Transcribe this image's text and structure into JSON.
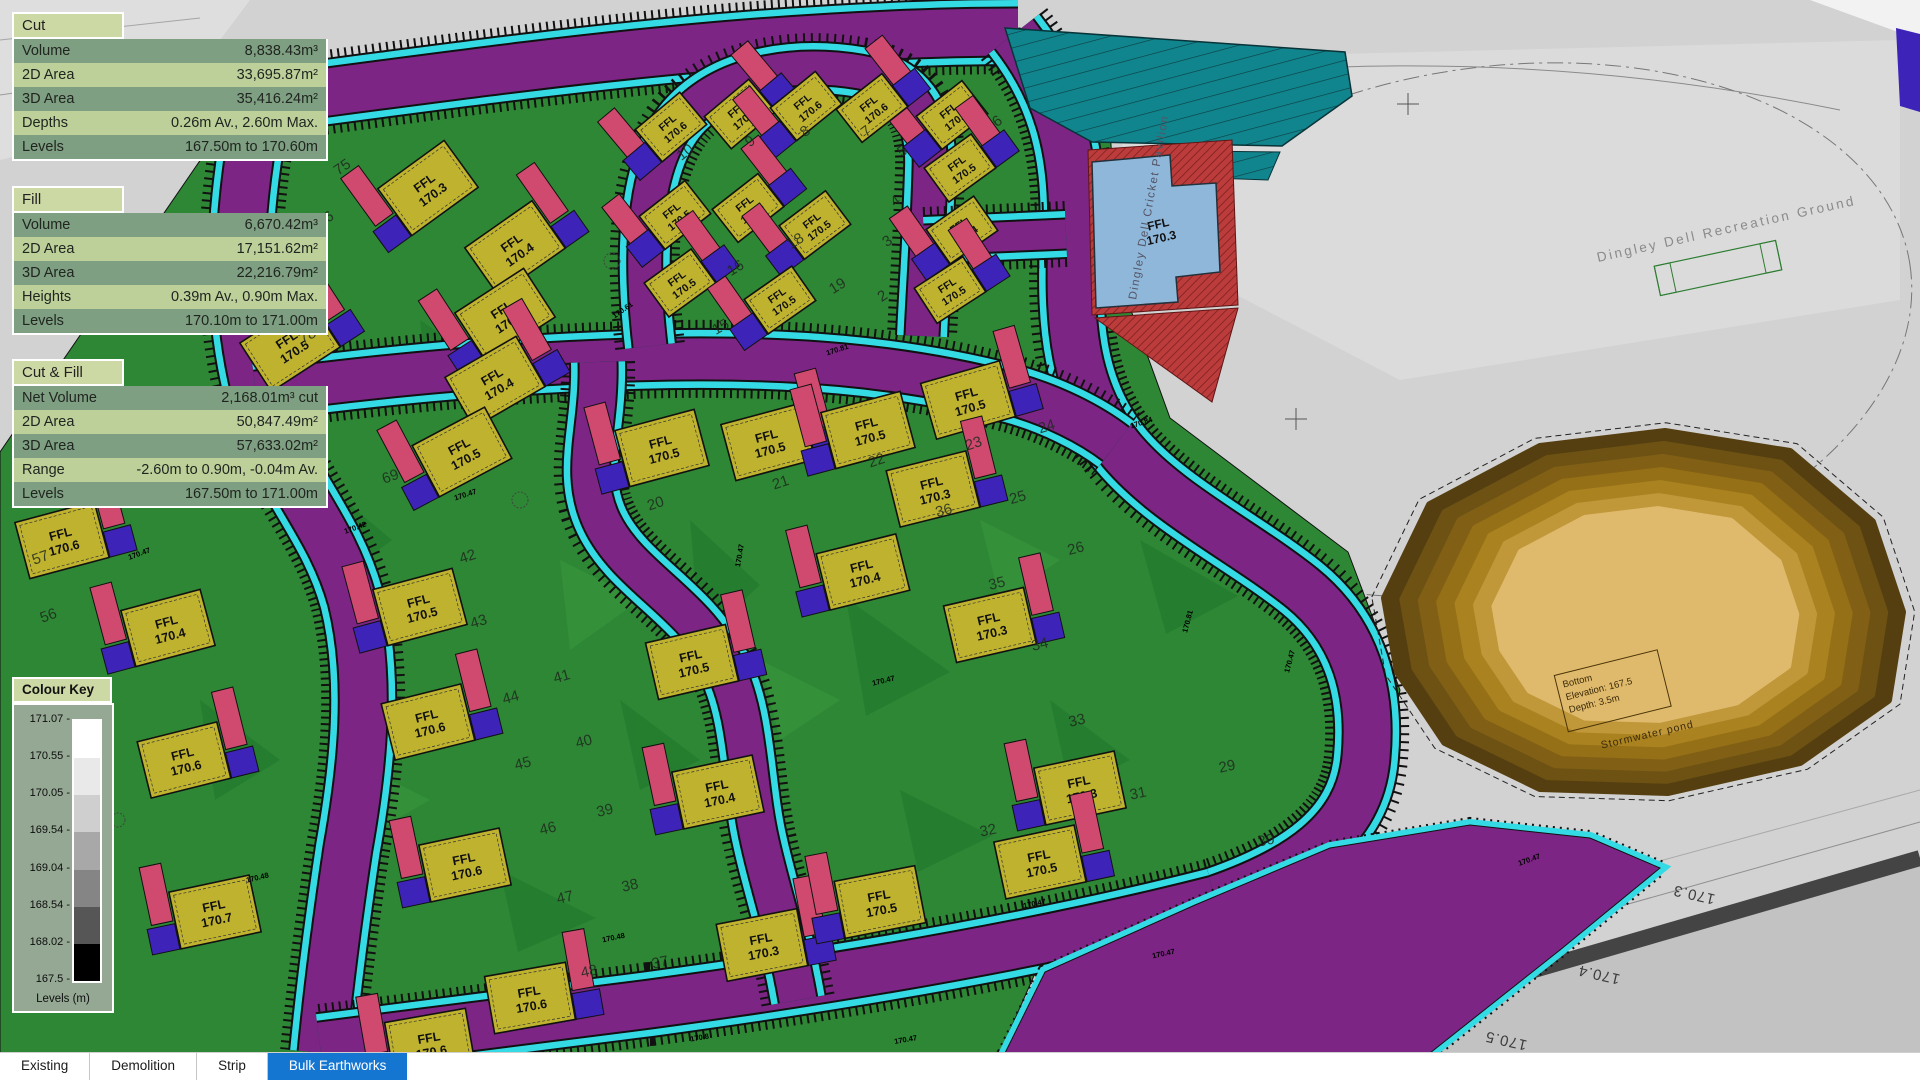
{
  "panels": [
    {
      "id": "cut",
      "title": "Cut",
      "rows": [
        [
          "Volume",
          "8,838.43m³"
        ],
        [
          "2D Area",
          "33,695.87m²"
        ],
        [
          "3D Area",
          "35,416.24m²"
        ],
        [
          "Depths",
          "0.26m Av., 2.60m Max."
        ],
        [
          "Levels",
          "167.50m to 170.60m"
        ]
      ]
    },
    {
      "id": "fill",
      "title": "Fill",
      "rows": [
        [
          "Volume",
          "6,670.42m³"
        ],
        [
          "2D Area",
          "17,151.62m²"
        ],
        [
          "3D Area",
          "22,216.79m²"
        ],
        [
          "Heights",
          "0.39m Av., 0.90m Max."
        ],
        [
          "Levels",
          "170.10m to 171.00m"
        ]
      ]
    },
    {
      "id": "cutfill",
      "title": "Cut & Fill",
      "rows": [
        [
          "Net Volume",
          "2,168.01m³ cut"
        ],
        [
          "2D Area",
          "50,847.49m²"
        ],
        [
          "3D Area",
          "57,633.02m²"
        ],
        [
          "Range",
          "-2.60m to 0.90m, -0.04m Av."
        ],
        [
          "Levels",
          "167.50m to 171.00m"
        ]
      ]
    }
  ],
  "colour_key": {
    "title": "Colour Key",
    "unit_label": "Levels (m)",
    "ticks": [
      "171.07",
      "170.55",
      "170.05",
      "169.54",
      "169.04",
      "168.54",
      "168.02",
      "167.5"
    ],
    "bands": [
      "#ffffff",
      "#e9e9e9",
      "#cfcfcf",
      "#a8a8a8",
      "#858585",
      "#565656",
      "#000000"
    ]
  },
  "tabs": {
    "items": [
      "Existing",
      "Demolition",
      "Strip",
      "Bulk Earthworks"
    ],
    "active": "Bulk Earthworks",
    "active_bg": "#1576d2"
  },
  "map": {
    "labels": {
      "recreation_ground": "Dingley Dell Recreation Ground",
      "pavilion": "Dingley Dell Cricket Pavilion",
      "pavilion_ffl_line1": "FFL",
      "pavilion_ffl_line2": "170.3",
      "pond_box_line1": "Bottom",
      "pond_box_line2": "Elevation: 167.5",
      "pond_box_line3": "Depth: 3.5m",
      "pond_caption": "Stormwater pond"
    },
    "ffl_prefix": "FFL",
    "colors": {
      "green": "#2e8735",
      "greendk": "#1b7427",
      "purple": "#7c2584",
      "cyan": "#35dbe4",
      "pink": "#cf4a6e",
      "blue": "#3d23b8",
      "yellow": "#bfb22f",
      "teal": "#11858d",
      "pav": "#8fb7da",
      "red": "#bc3c3c",
      "phead": "#cdd9a4",
      "rowdk": "#7e9f81",
      "rowlt": "#bdd09a",
      "ckbg": "#94a894",
      "gray": "#d2d2d2"
    },
    "pond_bands": [
      "#553f10",
      "#6d5213",
      "#816016",
      "#957017",
      "#aa8220",
      "#c09739",
      "#e0ba6c"
    ],
    "houses": [
      {
        "x": 428,
        "y": 188,
        "r": -36,
        "v": "170.3",
        "s": 1,
        "f": 0
      },
      {
        "x": 515,
        "y": 248,
        "r": -35,
        "v": "170.4",
        "s": 1,
        "f": 1
      },
      {
        "x": 505,
        "y": 315,
        "r": -33,
        "v": "170.4",
        "s": 1,
        "f": 0
      },
      {
        "x": 495,
        "y": 382,
        "r": -30,
        "v": "170.4",
        "s": 1,
        "f": 1
      },
      {
        "x": 462,
        "y": 452,
        "r": -28,
        "v": "170.5",
        "s": 1,
        "f": 0
      },
      {
        "x": 290,
        "y": 345,
        "r": -33,
        "v": "170.5",
        "s": 1,
        "f": 1
      },
      {
        "x": 150,
        "y": 448,
        "r": -30,
        "v": "170.6",
        "s": 1,
        "f": 0
      },
      {
        "x": 62,
        "y": 540,
        "r": -15,
        "v": "170.6",
        "s": 1,
        "f": 1
      },
      {
        "x": 168,
        "y": 628,
        "r": -15,
        "v": "170.4",
        "s": 1,
        "f": 0
      },
      {
        "x": 184,
        "y": 760,
        "r": -14,
        "v": "170.6",
        "s": 1,
        "f": 1
      },
      {
        "x": 215,
        "y": 912,
        "r": -12,
        "v": "170.7",
        "s": 1,
        "f": 0
      },
      {
        "x": 420,
        "y": 607,
        "r": -15,
        "v": "170.5",
        "s": 1,
        "f": 0
      },
      {
        "x": 428,
        "y": 722,
        "r": -14,
        "v": "170.6",
        "s": 1,
        "f": 1
      },
      {
        "x": 465,
        "y": 865,
        "r": -12,
        "v": "170.6",
        "s": 1,
        "f": 0
      },
      {
        "x": 530,
        "y": 998,
        "r": -10,
        "v": "170.6",
        "s": 1,
        "f": 1
      },
      {
        "x": 430,
        "y": 1044,
        "r": -10,
        "v": "170.6",
        "s": 1,
        "f": 0
      },
      {
        "x": 692,
        "y": 662,
        "r": -13,
        "v": "170.5",
        "s": 1,
        "f": 1
      },
      {
        "x": 718,
        "y": 792,
        "r": -12,
        "v": "170.4",
        "s": 1,
        "f": 0
      },
      {
        "x": 762,
        "y": 945,
        "r": -11,
        "v": "170.3",
        "s": 1,
        "f": 1
      },
      {
        "x": 880,
        "y": 902,
        "r": -11,
        "v": "170.5",
        "s": 1,
        "f": 0
      },
      {
        "x": 662,
        "y": 448,
        "r": -15,
        "v": "170.5",
        "s": 1,
        "f": 0
      },
      {
        "x": 768,
        "y": 442,
        "r": -15,
        "v": "170.5",
        "s": 1,
        "f": 1
      },
      {
        "x": 868,
        "y": 430,
        "r": -15,
        "v": "170.5",
        "s": 1,
        "f": 0
      },
      {
        "x": 968,
        "y": 400,
        "r": -16,
        "v": "170.5",
        "s": 1,
        "f": 1
      },
      {
        "x": 863,
        "y": 572,
        "r": -14,
        "v": "170.4",
        "s": 1,
        "f": 0
      },
      {
        "x": 933,
        "y": 489,
        "r": -14,
        "v": "170.3",
        "s": 1,
        "f": 1
      },
      {
        "x": 990,
        "y": 625,
        "r": -13,
        "v": "170.3",
        "s": 1,
        "f": 1
      },
      {
        "x": 1080,
        "y": 788,
        "r": -12,
        "v": "170.3",
        "s": 1,
        "f": 0
      },
      {
        "x": 1040,
        "y": 862,
        "r": -12,
        "v": "170.5",
        "s": 1,
        "f": 1
      },
      {
        "x": 952,
        "y": 115,
        "r": -38,
        "v": "170.6",
        "s": 2,
        "f": 0
      },
      {
        "x": 960,
        "y": 168,
        "r": -36,
        "v": "170.5",
        "s": 2,
        "f": 1
      },
      {
        "x": 962,
        "y": 230,
        "r": -35,
        "v": "170.4",
        "s": 2,
        "f": 0
      },
      {
        "x": 950,
        "y": 290,
        "r": -33,
        "v": "170.5",
        "s": 2,
        "f": 1
      },
      {
        "x": 671,
        "y": 127,
        "r": -40,
        "v": "170.6",
        "s": 2,
        "f": 0
      },
      {
        "x": 740,
        "y": 114,
        "r": -40,
        "v": "170.6",
        "s": 2,
        "f": 1
      },
      {
        "x": 806,
        "y": 106,
        "r": -39,
        "v": "170.6",
        "s": 2,
        "f": 0
      },
      {
        "x": 872,
        "y": 108,
        "r": -38,
        "v": "170.6",
        "s": 2,
        "f": 1
      },
      {
        "x": 675,
        "y": 215,
        "r": -38,
        "v": "170.5",
        "s": 2,
        "f": 0
      },
      {
        "x": 748,
        "y": 208,
        "r": -38,
        "v": "170.5",
        "s": 2,
        "f": 1
      },
      {
        "x": 815,
        "y": 225,
        "r": -37,
        "v": "170.5",
        "s": 2,
        "f": 0
      },
      {
        "x": 680,
        "y": 283,
        "r": -36,
        "v": "170.5",
        "s": 2,
        "f": 1
      },
      {
        "x": 780,
        "y": 300,
        "r": -35,
        "v": "170.5",
        "s": 2,
        "f": 0
      }
    ],
    "plot_numbers": [
      {
        "n": "57",
        "x": 42,
        "y": 562,
        "r": -20
      },
      {
        "n": "56",
        "x": 50,
        "y": 620,
        "r": -20
      },
      {
        "n": "75",
        "x": 345,
        "y": 171,
        "r": -35
      },
      {
        "n": "76",
        "x": 328,
        "y": 223,
        "r": -34
      },
      {
        "n": "77",
        "x": 318,
        "y": 282,
        "r": -33
      },
      {
        "n": "78",
        "x": 310,
        "y": 340,
        "r": -31
      },
      {
        "n": "79",
        "x": 306,
        "y": 400,
        "r": -29
      },
      {
        "n": "80",
        "x": 312,
        "y": 471,
        "r": -25
      },
      {
        "n": "69",
        "x": 392,
        "y": 481,
        "r": -20
      },
      {
        "n": "42",
        "x": 469,
        "y": 561,
        "r": -18
      },
      {
        "n": "43",
        "x": 480,
        "y": 626,
        "r": -17
      },
      {
        "n": "44",
        "x": 512,
        "y": 702,
        "r": -16
      },
      {
        "n": "45",
        "x": 524,
        "y": 768,
        "r": -15
      },
      {
        "n": "46",
        "x": 549,
        "y": 833,
        "r": -14
      },
      {
        "n": "47",
        "x": 566,
        "y": 902,
        "r": -13
      },
      {
        "n": "48",
        "x": 590,
        "y": 976,
        "r": -12
      },
      {
        "n": "38",
        "x": 631,
        "y": 890,
        "r": -13
      },
      {
        "n": "39",
        "x": 606,
        "y": 815,
        "r": -14
      },
      {
        "n": "40",
        "x": 585,
        "y": 746,
        "r": -15
      },
      {
        "n": "41",
        "x": 563,
        "y": 681,
        "r": -16
      },
      {
        "n": "37",
        "x": 661,
        "y": 967,
        "r": -12
      },
      {
        "n": "20",
        "x": 657,
        "y": 508,
        "r": -18
      },
      {
        "n": "21",
        "x": 782,
        "y": 487,
        "r": -18
      },
      {
        "n": "22",
        "x": 878,
        "y": 465,
        "r": -18
      },
      {
        "n": "23",
        "x": 975,
        "y": 448,
        "r": -18
      },
      {
        "n": "36",
        "x": 945,
        "y": 515,
        "r": -15
      },
      {
        "n": "24",
        "x": 1048,
        "y": 431,
        "r": -17
      },
      {
        "n": "25",
        "x": 1019,
        "y": 502,
        "r": -16
      },
      {
        "n": "26",
        "x": 1077,
        "y": 553,
        "r": -15
      },
      {
        "n": "34",
        "x": 1041,
        "y": 649,
        "r": -14
      },
      {
        "n": "35",
        "x": 998,
        "y": 588,
        "r": -14
      },
      {
        "n": "33",
        "x": 1078,
        "y": 725,
        "r": -13
      },
      {
        "n": "32",
        "x": 989,
        "y": 835,
        "r": -12
      },
      {
        "n": "31",
        "x": 1139,
        "y": 798,
        "r": -12
      },
      {
        "n": "30",
        "x": 1267,
        "y": 845,
        "r": -11
      },
      {
        "n": "29",
        "x": 1228,
        "y": 771,
        "r": -12
      },
      {
        "n": "15",
        "x": 723,
        "y": 331,
        "r": -30
      },
      {
        "n": "16",
        "x": 738,
        "y": 272,
        "r": -32
      },
      {
        "n": "18",
        "x": 798,
        "y": 245,
        "r": -33
      },
      {
        "n": "19",
        "x": 840,
        "y": 290,
        "r": -32
      },
      {
        "n": "10",
        "x": 688,
        "y": 156,
        "r": -38
      },
      {
        "n": "9",
        "x": 753,
        "y": 145,
        "r": -38
      },
      {
        "n": "8",
        "x": 808,
        "y": 135,
        "r": -38
      },
      {
        "n": "7",
        "x": 869,
        "y": 135,
        "r": -38
      },
      {
        "n": "6",
        "x": 1000,
        "y": 125,
        "r": -36
      },
      {
        "n": "5",
        "x": 905,
        "y": 155,
        "r": -36
      },
      {
        "n": "4",
        "x": 898,
        "y": 205,
        "r": -35
      },
      {
        "n": "3",
        "x": 890,
        "y": 245,
        "r": -34
      },
      {
        "n": "2",
        "x": 885,
        "y": 300,
        "r": -33
      }
    ],
    "spot_levels": [
      {
        "t": "170.47",
        "x": 466,
        "y": 497,
        "r": -18
      },
      {
        "t": "170.47",
        "x": 742,
        "y": 556,
        "r": -80
      },
      {
        "t": "170.47",
        "x": 884,
        "y": 683,
        "r": -14
      },
      {
        "t": "170.47",
        "x": 1035,
        "y": 906,
        "r": -12
      },
      {
        "t": "170.48",
        "x": 258,
        "y": 880,
        "r": -14
      },
      {
        "t": "170.48",
        "x": 614,
        "y": 940,
        "r": -12
      },
      {
        "t": "170.81",
        "x": 838,
        "y": 352,
        "r": -18
      },
      {
        "t": "170.84",
        "x": 1142,
        "y": 425,
        "r": -18
      },
      {
        "t": "170.81",
        "x": 1190,
        "y": 622,
        "r": -75
      },
      {
        "t": "170.47",
        "x": 1292,
        "y": 662,
        "r": -75
      },
      {
        "t": "170.42",
        "x": 356,
        "y": 530,
        "r": -20
      },
      {
        "t": "170.47",
        "x": 140,
        "y": 556,
        "r": -20
      },
      {
        "t": "170.47",
        "x": 906,
        "y": 1042,
        "r": -10
      },
      {
        "t": "170.47",
        "x": 1164,
        "y": 956,
        "r": -12
      },
      {
        "t": "170.8",
        "x": 700,
        "y": 1040,
        "r": -10
      },
      {
        "t": "170.75",
        "x": 250,
        "y": 262,
        "r": -33
      },
      {
        "t": "170.61",
        "x": 624,
        "y": 312,
        "r": -35
      },
      {
        "t": "170.47",
        "x": 1530,
        "y": 862,
        "r": -20
      }
    ],
    "contour_labels": [
      {
        "t": "170.3",
        "x": 1695,
        "y": 890,
        "r": 193
      },
      {
        "t": "170.4",
        "x": 1600,
        "y": 970,
        "r": 193
      },
      {
        "t": "170.5",
        "x": 1507,
        "y": 1036,
        "r": 193
      }
    ]
  }
}
